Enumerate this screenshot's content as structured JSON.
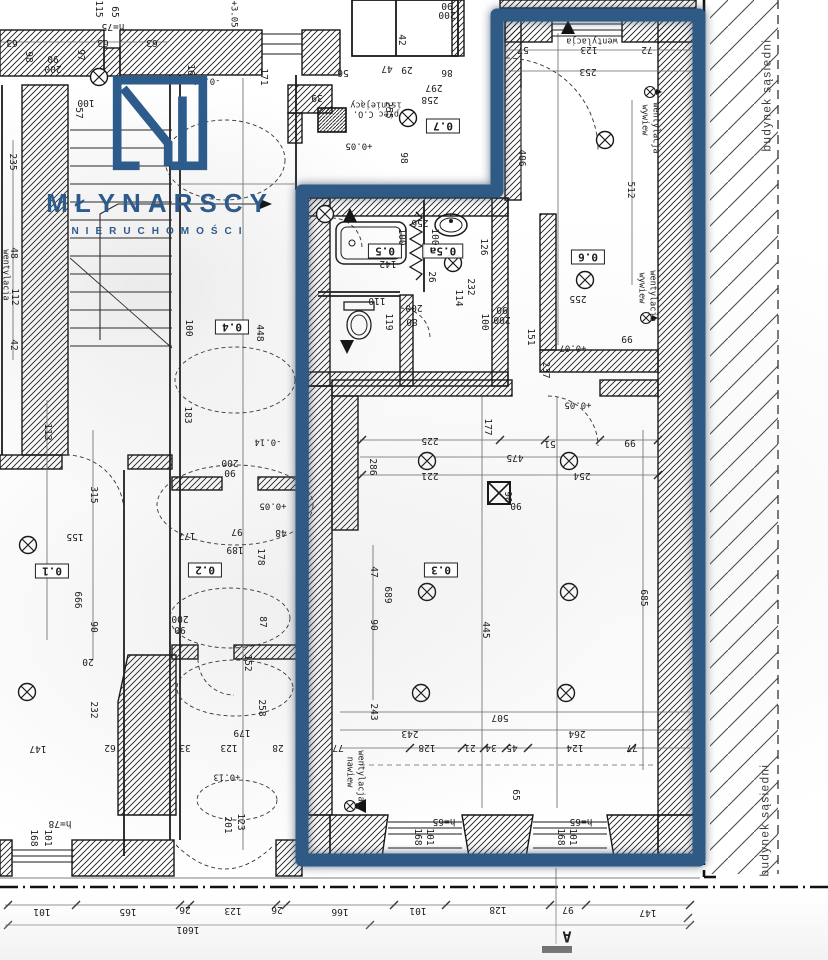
{
  "brand": {
    "title": "MŁYNARSCY",
    "subtitle": "NIERUCHOMOŚCI"
  },
  "colors": {
    "outline_blue": "#2e5a85",
    "logo_blue": "#2d5b8c",
    "ink": "#1c1c1c"
  },
  "plan": {
    "neighbor_building_label": "budynek sąsiedni",
    "section_marker": "A",
    "total_width_dimension": "1601"
  },
  "annotations": [
    {
      "t": "0.1",
      "x": 52,
      "y": 571,
      "r": 180,
      "k": "r",
      "n": "room-label-0-1"
    },
    {
      "t": "0.2",
      "x": 205,
      "y": 570,
      "r": 180,
      "k": "r",
      "n": "room-label-0-2"
    },
    {
      "t": "0.3",
      "x": 441,
      "y": 570,
      "r": 180,
      "k": "r",
      "n": "room-label-0-3"
    },
    {
      "t": "0.4",
      "x": 232,
      "y": 327,
      "r": 180,
      "k": "r",
      "n": "room-label-0-4"
    },
    {
      "t": "0.5",
      "x": 385,
      "y": 251,
      "r": 180,
      "k": "r",
      "n": "room-label-0-5"
    },
    {
      "t": "0.5a",
      "x": 443,
      "y": 251,
      "r": 180,
      "k": "r",
      "n": "room-label-0-5a"
    },
    {
      "t": "0.6",
      "x": 588,
      "y": 257,
      "r": 180,
      "k": "r",
      "n": "room-label-0-6"
    },
    {
      "t": "0.7",
      "x": 443,
      "y": 126,
      "r": 180,
      "k": "r",
      "n": "room-label-0-7"
    },
    {
      "t": "63",
      "x": 12,
      "y": 42,
      "r": 180
    },
    {
      "t": "98",
      "x": 28,
      "y": 57,
      "r": 90
    },
    {
      "t": "90",
      "x": 53,
      "y": 58,
      "r": 180
    },
    {
      "t": "200",
      "x": 53,
      "y": 68,
      "r": 180
    },
    {
      "t": "63",
      "x": 103,
      "y": 42,
      "r": 180
    },
    {
      "t": "63",
      "x": 152,
      "y": 42,
      "r": 180
    },
    {
      "t": "115",
      "x": 98,
      "y": 9,
      "r": 90
    },
    {
      "t": "65",
      "x": 114,
      "y": 12,
      "r": 90
    },
    {
      "t": "h=75",
      "x": 113,
      "y": 26,
      "r": 180
    },
    {
      "t": "97",
      "x": 80,
      "y": 55,
      "r": 90
    },
    {
      "t": "171",
      "x": 263,
      "y": 77,
      "r": 90
    },
    {
      "t": "-0.14",
      "x": 207,
      "y": 80,
      "r": 180,
      "k": "l"
    },
    {
      "t": "57",
      "x": 78,
      "y": 113,
      "r": 90
    },
    {
      "t": "100",
      "x": 86,
      "y": 102,
      "r": 180
    },
    {
      "t": "16",
      "x": 190,
      "y": 70,
      "r": 90
    },
    {
      "t": "+3.05",
      "x": 233,
      "y": 14,
      "r": 90,
      "k": "l"
    },
    {
      "t": "235",
      "x": 12,
      "y": 162,
      "r": 90
    },
    {
      "t": "48",
      "x": 13,
      "y": 253,
      "r": 90
    },
    {
      "t": "112",
      "x": 14,
      "y": 297,
      "r": 90
    },
    {
      "t": "42",
      "x": 13,
      "y": 345,
      "r": 90
    },
    {
      "t": "wentylacja",
      "x": 5,
      "y": 275,
      "r": 90,
      "k": "t"
    },
    {
      "t": "39",
      "x": 317,
      "y": 97,
      "r": 180
    },
    {
      "t": "100",
      "x": 188,
      "y": 328,
      "r": 90
    },
    {
      "t": "448",
      "x": 259,
      "y": 333,
      "r": 90
    },
    {
      "t": "183",
      "x": 187,
      "y": 415,
      "r": 90
    },
    {
      "t": "-0.14",
      "x": 268,
      "y": 441,
      "r": 180,
      "k": "l"
    },
    {
      "t": "200",
      "x": 230,
      "y": 462,
      "r": 180
    },
    {
      "t": "90",
      "x": 230,
      "y": 472,
      "r": 180
    },
    {
      "t": "+0.05",
      "x": 273,
      "y": 505,
      "r": 180,
      "k": "l"
    },
    {
      "t": "177",
      "x": 187,
      "y": 535,
      "r": 180
    },
    {
      "t": "97",
      "x": 237,
      "y": 531,
      "r": 180
    },
    {
      "t": "48",
      "x": 281,
      "y": 532,
      "r": 180
    },
    {
      "t": "189",
      "x": 235,
      "y": 549,
      "r": 180
    },
    {
      "t": "178",
      "x": 260,
      "y": 557,
      "r": 90
    },
    {
      "t": "87",
      "x": 262,
      "y": 622,
      "r": 90
    },
    {
      "t": "200",
      "x": 180,
      "y": 618,
      "r": 180
    },
    {
      "t": "90",
      "x": 180,
      "y": 629,
      "r": 180
    },
    {
      "t": "152",
      "x": 247,
      "y": 663,
      "r": 90
    },
    {
      "t": "258",
      "x": 261,
      "y": 708,
      "r": 90
    },
    {
      "t": "179",
      "x": 242,
      "y": 732,
      "r": 180
    },
    {
      "t": "33",
      "x": 185,
      "y": 747,
      "r": 180
    },
    {
      "t": "123",
      "x": 229,
      "y": 747,
      "r": 180
    },
    {
      "t": "28",
      "x": 278,
      "y": 747,
      "r": 180
    },
    {
      "t": "+0.13",
      "x": 227,
      "y": 776,
      "r": 180,
      "k": "l"
    },
    {
      "t": "201",
      "x": 227,
      "y": 825,
      "r": 90
    },
    {
      "t": "123",
      "x": 240,
      "y": 822,
      "r": 90
    },
    {
      "t": "113",
      "x": 47,
      "y": 432,
      "r": 90
    },
    {
      "t": "315",
      "x": 93,
      "y": 495,
      "r": 90
    },
    {
      "t": "155",
      "x": 75,
      "y": 536,
      "r": 180
    },
    {
      "t": "666",
      "x": 77,
      "y": 600,
      "r": 90
    },
    {
      "t": "90",
      "x": 93,
      "y": 627,
      "r": 90
    },
    {
      "t": "20",
      "x": 88,
      "y": 661,
      "r": 180
    },
    {
      "t": "232",
      "x": 93,
      "y": 710,
      "r": 90
    },
    {
      "t": "147",
      "x": 38,
      "y": 748,
      "r": 180
    },
    {
      "t": "62",
      "x": 110,
      "y": 747,
      "r": 180
    },
    {
      "t": "h=78",
      "x": 60,
      "y": 823,
      "r": 180
    },
    {
      "t": "168",
      "x": 33,
      "y": 838,
      "r": 90
    },
    {
      "t": "101",
      "x": 47,
      "y": 838,
      "r": 90
    },
    {
      "t": "142",
      "x": 388,
      "y": 263,
      "r": 180
    },
    {
      "t": "256",
      "x": 420,
      "y": 222,
      "r": 180
    },
    {
      "t": "100",
      "x": 401,
      "y": 237,
      "r": 90
    },
    {
      "t": "100",
      "x": 434,
      "y": 237,
      "r": 90
    },
    {
      "t": "126",
      "x": 483,
      "y": 247,
      "r": 90
    },
    {
      "t": "26",
      "x": 431,
      "y": 277,
      "r": 90
    },
    {
      "t": "232",
      "x": 470,
      "y": 287,
      "r": 90
    },
    {
      "t": "114",
      "x": 458,
      "y": 298,
      "r": 90
    },
    {
      "t": "110",
      "x": 377,
      "y": 300,
      "r": 180
    },
    {
      "t": "200",
      "x": 414,
      "y": 307,
      "r": 180
    },
    {
      "t": "80",
      "x": 412,
      "y": 321,
      "r": 180
    },
    {
      "t": "119",
      "x": 388,
      "y": 322,
      "r": 90
    },
    {
      "t": "90",
      "x": 502,
      "y": 309,
      "r": 180
    },
    {
      "t": "200",
      "x": 502,
      "y": 319,
      "r": 180
    },
    {
      "t": "100",
      "x": 484,
      "y": 322,
      "r": 90
    },
    {
      "t": "151",
      "x": 530,
      "y": 337,
      "r": 90
    },
    {
      "t": "237",
      "x": 545,
      "y": 370,
      "r": 90
    },
    {
      "t": "56",
      "x": 343,
      "y": 72,
      "r": 180
    },
    {
      "t": "42",
      "x": 401,
      "y": 40,
      "r": 90
    },
    {
      "t": "47",
      "x": 387,
      "y": 68,
      "r": 180
    },
    {
      "t": "29",
      "x": 407,
      "y": 69,
      "r": 180
    },
    {
      "t": "86",
      "x": 447,
      "y": 72,
      "r": 180
    },
    {
      "t": "297",
      "x": 434,
      "y": 87,
      "r": 180
    },
    {
      "t": "258",
      "x": 430,
      "y": 99,
      "r": 180
    },
    {
      "t": "255",
      "x": 388,
      "y": 110,
      "r": 90
    },
    {
      "t": "98",
      "x": 403,
      "y": 158,
      "r": 90
    },
    {
      "t": "+0.05",
      "x": 359,
      "y": 145,
      "r": 180,
      "k": "l"
    },
    {
      "t": "90",
      "x": 447,
      "y": 5,
      "r": 180
    },
    {
      "t": "200",
      "x": 447,
      "y": 14,
      "r": 180
    },
    {
      "t": "57",
      "x": 523,
      "y": 49,
      "r": 180
    },
    {
      "t": "123",
      "x": 589,
      "y": 49,
      "r": 180
    },
    {
      "t": "72",
      "x": 647,
      "y": 49,
      "r": 180
    },
    {
      "t": "253",
      "x": 588,
      "y": 71,
      "r": 180
    },
    {
      "t": "406",
      "x": 521,
      "y": 158,
      "r": 90
    },
    {
      "t": "512",
      "x": 630,
      "y": 190,
      "r": 90
    },
    {
      "t": "255",
      "x": 578,
      "y": 298,
      "r": 180
    },
    {
      "t": "99",
      "x": 627,
      "y": 338,
      "r": 180
    },
    {
      "t": "+0.07",
      "x": 573,
      "y": 347,
      "r": 180,
      "k": "l"
    },
    {
      "t": "225",
      "x": 430,
      "y": 440,
      "r": 180
    },
    {
      "t": "177",
      "x": 487,
      "y": 427,
      "r": 90
    },
    {
      "t": "51",
      "x": 550,
      "y": 443,
      "r": 180
    },
    {
      "t": "99",
      "x": 630,
      "y": 442,
      "r": 180
    },
    {
      "t": "475",
      "x": 515,
      "y": 457,
      "r": 180
    },
    {
      "t": "221",
      "x": 430,
      "y": 475,
      "r": 180
    },
    {
      "t": "254",
      "x": 582,
      "y": 475,
      "r": 180
    },
    {
      "t": "286",
      "x": 372,
      "y": 467,
      "r": 90
    },
    {
      "t": "+0.05",
      "x": 578,
      "y": 404,
      "r": 180,
      "k": "l"
    },
    {
      "t": "689",
      "x": 387,
      "y": 595,
      "r": 90
    },
    {
      "t": "47",
      "x": 373,
      "y": 572,
      "r": 90
    },
    {
      "t": "90",
      "x": 373,
      "y": 625,
      "r": 90
    },
    {
      "t": "445",
      "x": 485,
      "y": 630,
      "r": 90
    },
    {
      "t": "685",
      "x": 643,
      "y": 598,
      "r": 90
    },
    {
      "t": "90",
      "x": 507,
      "y": 497,
      "r": 90
    },
    {
      "t": "90",
      "x": 516,
      "y": 505,
      "r": 180
    },
    {
      "t": "243",
      "x": 373,
      "y": 712,
      "r": 90
    },
    {
      "t": "507",
      "x": 500,
      "y": 717,
      "r": 180
    },
    {
      "t": "243",
      "x": 410,
      "y": 733,
      "r": 180
    },
    {
      "t": "264",
      "x": 577,
      "y": 733,
      "r": 180
    },
    {
      "t": "128",
      "x": 427,
      "y": 747,
      "r": 180
    },
    {
      "t": "21",
      "x": 470,
      "y": 747,
      "r": 180
    },
    {
      "t": "34",
      "x": 491,
      "y": 747,
      "r": 180
    },
    {
      "t": "45",
      "x": 512,
      "y": 747,
      "r": 180
    },
    {
      "t": "124",
      "x": 575,
      "y": 747,
      "r": 180
    },
    {
      "t": "77",
      "x": 632,
      "y": 747,
      "r": 180
    },
    {
      "t": "77",
      "x": 338,
      "y": 747,
      "r": 180
    },
    {
      "t": "65",
      "x": 515,
      "y": 795,
      "r": 90
    },
    {
      "t": "168",
      "x": 417,
      "y": 837,
      "r": 90
    },
    {
      "t": "101",
      "x": 429,
      "y": 837,
      "r": 90
    },
    {
      "t": "168",
      "x": 560,
      "y": 837,
      "r": 90
    },
    {
      "t": "101",
      "x": 572,
      "y": 837,
      "r": 90
    },
    {
      "t": "h=65",
      "x": 444,
      "y": 821,
      "r": 180
    },
    {
      "t": "h=65",
      "x": 581,
      "y": 821,
      "r": 180
    },
    {
      "t": "101",
      "x": 42,
      "y": 911,
      "r": 180
    },
    {
      "t": "165",
      "x": 128,
      "y": 911,
      "r": 180
    },
    {
      "t": "26",
      "x": 185,
      "y": 909,
      "r": 180
    },
    {
      "t": "123",
      "x": 233,
      "y": 910,
      "r": 180
    },
    {
      "t": "26",
      "x": 277,
      "y": 909,
      "r": 180
    },
    {
      "t": "166",
      "x": 340,
      "y": 911,
      "r": 180
    },
    {
      "t": "101",
      "x": 418,
      "y": 910,
      "r": 180
    },
    {
      "t": "128",
      "x": 498,
      "y": 909,
      "r": 180
    },
    {
      "t": "97",
      "x": 568,
      "y": 909,
      "r": 180
    },
    {
      "t": "147",
      "x": 648,
      "y": 912,
      "r": 180
    },
    {
      "t": "1601",
      "x": 188,
      "y": 929,
      "r": 180
    },
    {
      "t": "wentylacja",
      "x": 592,
      "y": 40,
      "r": 180,
      "k": "t"
    },
    {
      "t": "wywiew",
      "x": 644,
      "y": 120,
      "r": 90,
      "k": "t"
    },
    {
      "t": "wentylacja",
      "x": 655,
      "y": 128,
      "r": 90,
      "k": "t"
    },
    {
      "t": "wywiew",
      "x": 641,
      "y": 288,
      "r": 90,
      "k": "t"
    },
    {
      "t": "wentylacja",
      "x": 652,
      "y": 296,
      "r": 90,
      "k": "t"
    },
    {
      "t": "nawiew",
      "x": 349,
      "y": 772,
      "r": 90,
      "k": "t"
    },
    {
      "t": "wentylacja",
      "x": 360,
      "y": 776,
      "r": 90,
      "k": "t"
    },
    {
      "t": "istniejący",
      "x": 376,
      "y": 104,
      "r": 180,
      "k": "t"
    },
    {
      "t": "piec C.O.",
      "x": 376,
      "y": 113,
      "r": 180,
      "k": "t"
    },
    {
      "t": "budynek sąsiedni",
      "x": 768,
      "y": 95,
      "r": -90,
      "k": "g",
      "n": "neighbor-building-label"
    },
    {
      "t": "budynek sąsiedni",
      "x": 766,
      "y": 820,
      "r": -90,
      "k": "g",
      "n": "neighbor-building-label"
    },
    {
      "t": "A",
      "x": 567,
      "y": 936,
      "r": 180,
      "k": "s",
      "n": "section-marker-a"
    }
  ],
  "symbols": {
    "lamps": [
      [
        99,
        77
      ],
      [
        325,
        214
      ],
      [
        28,
        545
      ],
      [
        27,
        692
      ],
      [
        408,
        118
      ],
      [
        453,
        263
      ],
      [
        585,
        280
      ],
      [
        605,
        140
      ],
      [
        427,
        461
      ],
      [
        569,
        461
      ],
      [
        427,
        592
      ],
      [
        569,
        592
      ],
      [
        421,
        693
      ],
      [
        566,
        693
      ]
    ],
    "vents": [
      [
        650,
        92
      ],
      [
        646,
        318
      ],
      [
        350,
        806
      ]
    ]
  }
}
